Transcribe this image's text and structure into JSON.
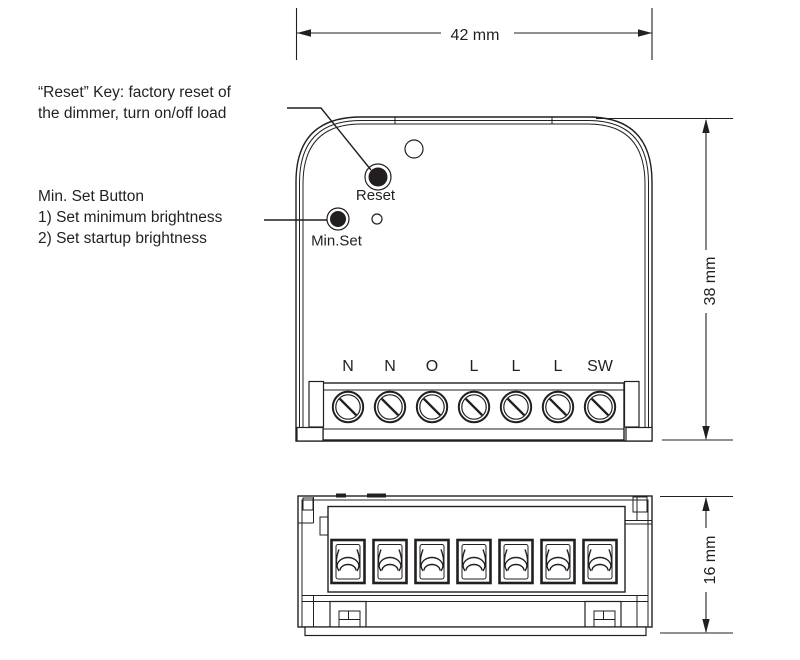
{
  "colors": {
    "terminal_blue": "#29abe2",
    "line": "#231f20"
  },
  "annotations": {
    "reset_note": {
      "line1": "“Reset” Key: factory reset of",
      "line2": "the dimmer, turn on/off load"
    },
    "minset_note": {
      "line1": "Min. Set Button",
      "line2": "1) Set minimum brightness",
      "line3": "2) Set startup brightness"
    }
  },
  "dimensions": {
    "width_label": "42 mm",
    "height_label": "38 mm",
    "depth_label": "16 mm"
  },
  "front_view": {
    "reset_button_label": "Reset",
    "minset_button_label": "Min.Set",
    "terminal_labels": [
      "N",
      "N",
      "O",
      "L",
      "L",
      "L",
      "SW"
    ]
  }
}
